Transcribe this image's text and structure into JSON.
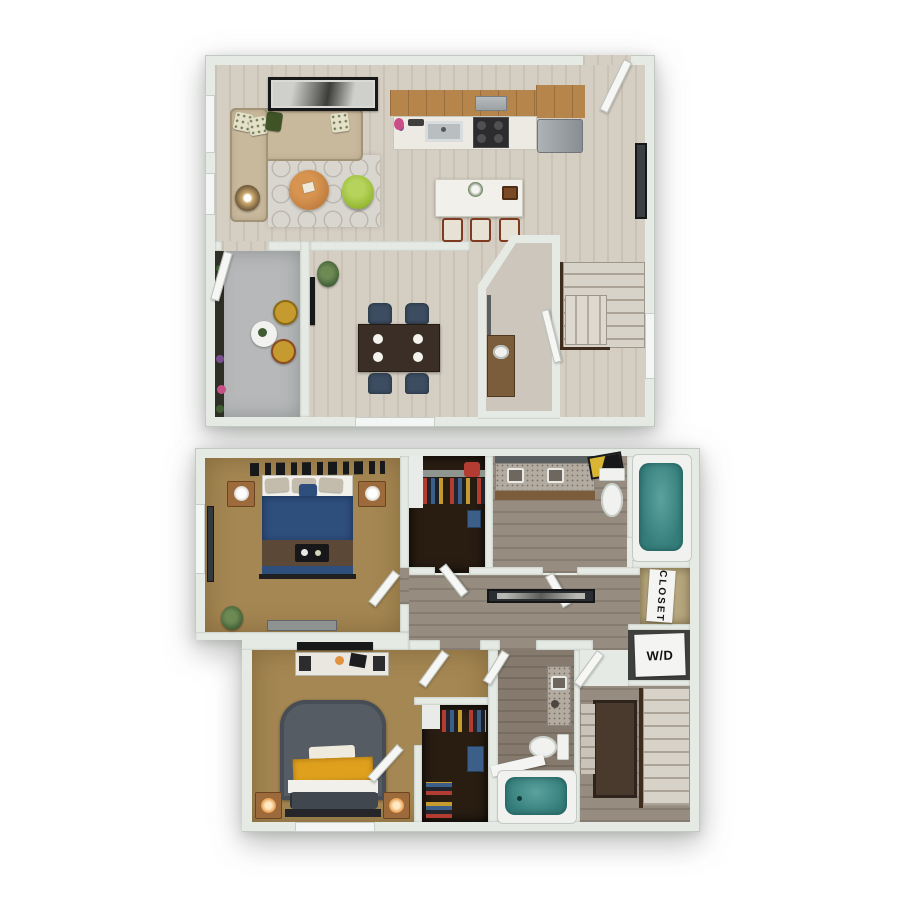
{
  "page": {
    "background": "#ffffff",
    "description": "3D-style two-level apartment floor plan rendering on white background"
  },
  "labels": {
    "closet": "CLOSET",
    "washer_dryer": "W/D"
  },
  "palette": {
    "pageBg": "#ffffff",
    "wall": "#e6eae5",
    "wallLine": "#c2c9c2",
    "wood": "#d5cec2",
    "hallWood": "#968c80",
    "bathWood": "#857a6d",
    "balcony": "#b6b8b9",
    "planter": "#2e3026",
    "rug": "#d9d6cf",
    "sofa": "#c8b89c",
    "pillowLight": "#e4e1c9",
    "pillowGreen": "#3f5327",
    "artFrame": "#17181a",
    "tableWood": "#c07c3e",
    "chairGreen": "#96ba35",
    "lampBase": "#4c3a28",
    "cabinetWood": "#b5854c",
    "counter": "#eceae3",
    "stove": "#2c2c2e",
    "hood": "#9aa0a2",
    "fridge": "#9aa1a4",
    "island": "#f1f0ea",
    "stoolSeat": "#e7e2d4",
    "stoolLeg": "#7e3b22",
    "diningTable": "#3a2e26",
    "diningChair": "#3c4d61",
    "plate": "#f4f3ee",
    "stairTread": "#d8d3c9",
    "stairTreadDark": "#aba396",
    "railing": "#3e2c1d",
    "doorLeaf": "#f6f7f5",
    "glass": "#f3f6f4",
    "carpet": "#a58753",
    "closetDark": "#291d12",
    "shelfWhite": "#e9ebe8",
    "bedBlue": "#2e4e7c",
    "blanketBrown": "#5c4836",
    "bedWhite": "#f2f0ea",
    "bedGray": "#565c64",
    "throwYellow": "#dfa11d",
    "pillowDark": "#41474f",
    "nightstand": "#9c6a3b",
    "lampGlow": "#e2913c",
    "tubTeal": "#357d7a",
    "fixture": "#f1f2ef",
    "granite": "#b3aba0",
    "vanityWood": "#7b5d3c",
    "mirror": "#5a5f62",
    "decorGold": "#d8b633",
    "wdSurround": "#3f403e",
    "tv": "#17181a",
    "plant": "#3f5c33",
    "flowerPink": "#c94f86",
    "flowerPurple": "#7a4f8f",
    "denim": "#3b5f88",
    "clothesRed": "#b23b32",
    "clothesYellow": "#c59a2f"
  },
  "floors": [
    {
      "name": "first-floor",
      "rooms": [
        "living-room",
        "kitchen",
        "dining-area",
        "powder-room",
        "stair-hall",
        "balcony",
        "entry"
      ],
      "items": [
        "sectional-sofa",
        "throw-pillows",
        "wall-art",
        "round-coffee-table",
        "accent-chair",
        "floor-lamp",
        "area-rug",
        "kitchen-counter",
        "sink",
        "gas-range",
        "range-hood",
        "refrigerator",
        "kitchen-island",
        "bar-stools",
        "dining-table",
        "dining-chairs",
        "powder-sink",
        "staircase-up",
        "balcony-bistro-table",
        "balcony-chairs",
        "flower-planters",
        "potted-plant",
        "entry-door",
        "balcony-door"
      ]
    },
    {
      "name": "second-floor",
      "rooms": [
        "bedroom-1",
        "walk-in-closet-1",
        "bathroom-1",
        "hallway",
        "linen-closet",
        "laundry-closet",
        "bedroom-2",
        "walk-in-closet-2",
        "bathroom-2",
        "stairwell"
      ],
      "items": [
        "queen-bed-blue",
        "nightstands",
        "table-lamps",
        "headboard-decor",
        "dresser",
        "wall-art",
        "double-vanity",
        "toilet",
        "bathtub",
        "media-console",
        "wall-tv",
        "queen-bed-gray",
        "yellow-throw",
        "single-vanity",
        "staircase-down",
        "hanging-clothes"
      ]
    }
  ]
}
